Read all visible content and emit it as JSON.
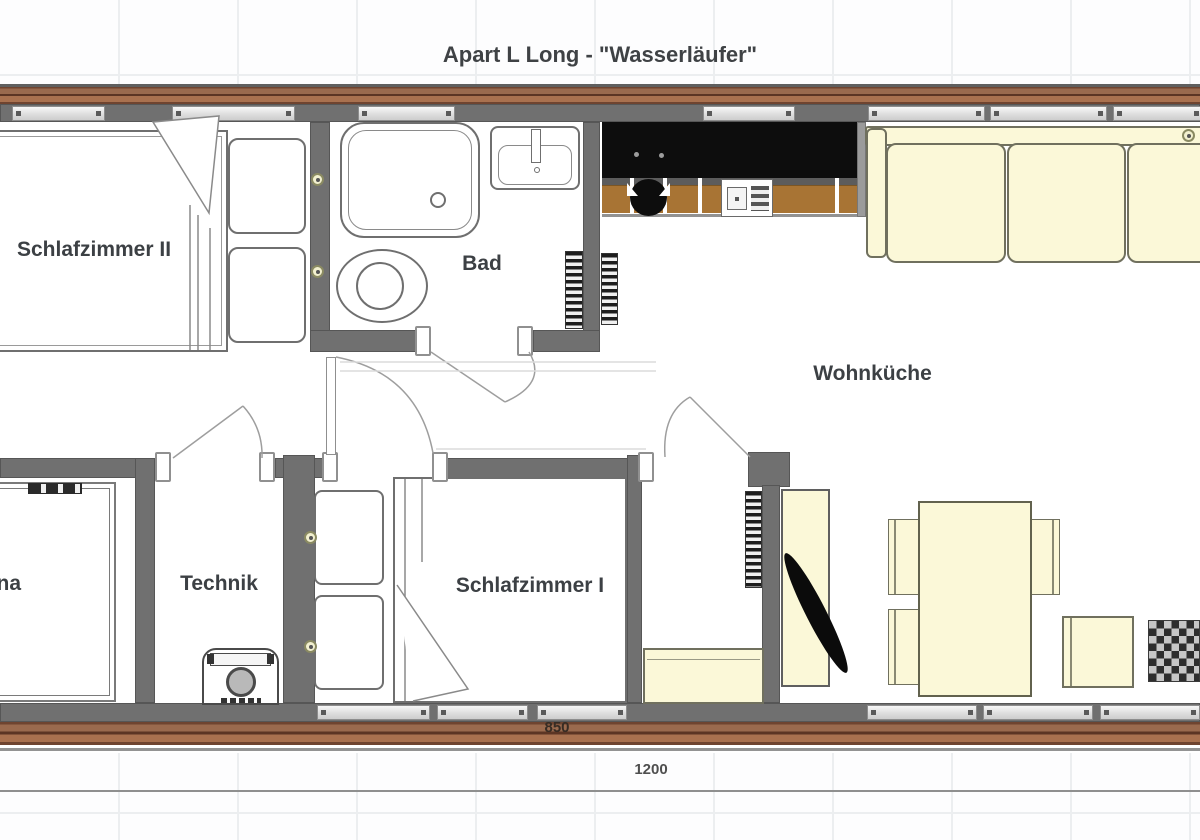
{
  "title": "Apart L Long - \"Wasserläufer\"",
  "rooms": {
    "schlafzimmer2": {
      "label": "Schlafzimmer II"
    },
    "bad": {
      "label": "Bad"
    },
    "wohnkueche": {
      "label": "Wohnküche"
    },
    "sauna": {
      "label": "Sauna"
    },
    "technik": {
      "label": "Technik"
    },
    "schlafzimmer1": {
      "label": "Schlafzimmer I"
    }
  },
  "dimensions": {
    "overall_width": "1200",
    "window_run": "850"
  },
  "colors": {
    "wall": "#707070",
    "wood": "#9a6a4e",
    "furniture": "#fbf8d8",
    "counter": "#a87434",
    "appliance_black": "#0d0d0d",
    "window_fill": "#e7e7e7",
    "label_text": "#3c4044",
    "grid": "#eceef0"
  }
}
